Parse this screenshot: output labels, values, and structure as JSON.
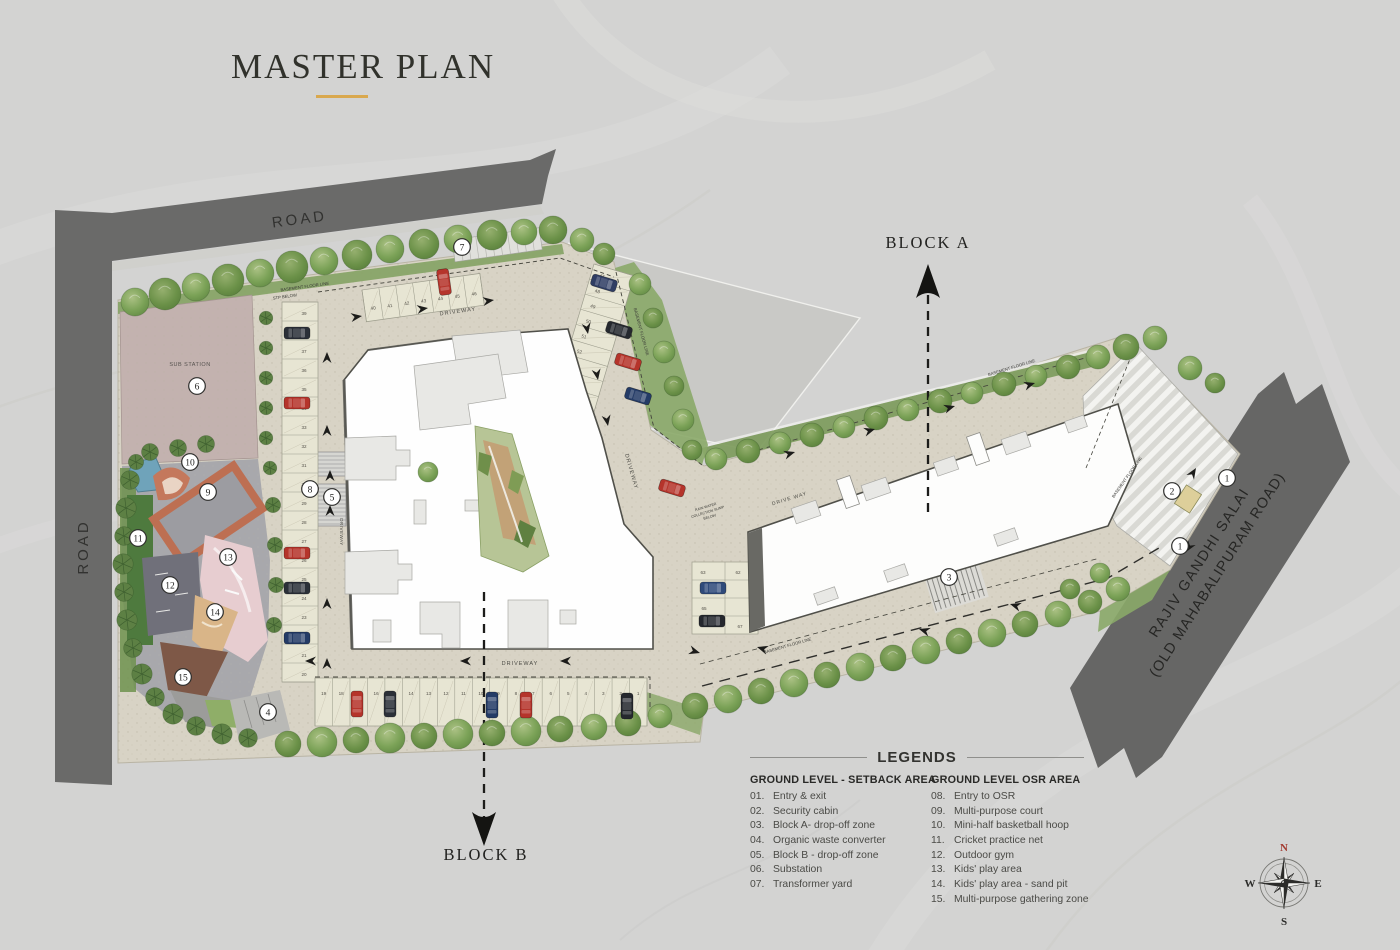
{
  "title": {
    "text": "MASTER PLAN"
  },
  "theme": {
    "accent": "#d9a84e",
    "road": "#6a6a69",
    "site": "#d8d3c5",
    "osr_paving": "#a8a8ac",
    "building": "#fdfdfc",
    "tree_green": "#7f9d60",
    "court_border": "#bd6f52",
    "sand": "#d9b588",
    "pond": "#6fa3ba",
    "marker_red": "#b5342b"
  },
  "labels": {
    "road_top": "ROAD",
    "road_left": "ROAD",
    "highway_line1": "RAJIV GANDHI SALAI",
    "highway_line2": "(OLD MAHABALIPURAM ROAD)",
    "block_a": "BLOCK A",
    "block_b": "BLOCK B",
    "sub_station": "SUB STATION",
    "driveway": "DRIVEWAY",
    "drive_way": "DRIVE WAY",
    "basement_floor_line": "BASEMENT FLOOR LINE",
    "stp_below": "STP BELOW",
    "rain_water_1": "RAIN WATER",
    "rain_water_2": "COLLECTION SUMP",
    "rain_water_3": "BELOW"
  },
  "legend": {
    "heading": "LEGENDS",
    "columns": [
      {
        "header": "GROUND LEVEL - SETBACK AREA",
        "items": [
          {
            "num": "01.",
            "label": "Entry & exit"
          },
          {
            "num": "02.",
            "label": "Security cabin"
          },
          {
            "num": "03.",
            "label": "Block A- drop-off zone"
          },
          {
            "num": "04.",
            "label": "Organic waste converter"
          },
          {
            "num": "05.",
            "label": "Block B - drop-off zone"
          },
          {
            "num": "06.",
            "label": "Substation"
          },
          {
            "num": "07.",
            "label": "Transformer yard"
          }
        ]
      },
      {
        "header": "GROUND LEVEL OSR AREA",
        "items": [
          {
            "num": "08.",
            "label": "Entry to OSR"
          },
          {
            "num": "09.",
            "label": "Multi-purpose court"
          },
          {
            "num": "10.",
            "label": "Mini-half basketball hoop"
          },
          {
            "num": "11.",
            "label": "Cricket practice net"
          },
          {
            "num": "12.",
            "label": "Outdoor gym"
          },
          {
            "num": "13.",
            "label": "Kids' play area"
          },
          {
            "num": "14.",
            "label": "Kids' play area - sand pit"
          },
          {
            "num": "15.",
            "label": "Multi-purpose gathering zone"
          }
        ]
      }
    ]
  },
  "compass": {
    "n": "N",
    "e": "E",
    "s": "S",
    "w": "W"
  },
  "markers": [
    {
      "n": "1",
      "x": 1227,
      "y": 478
    },
    {
      "n": "1",
      "x": 1180,
      "y": 546
    },
    {
      "n": "2",
      "x": 1172,
      "y": 491
    },
    {
      "n": "3",
      "x": 949,
      "y": 577
    },
    {
      "n": "4",
      "x": 268,
      "y": 712
    },
    {
      "n": "5",
      "x": 332,
      "y": 497
    },
    {
      "n": "6",
      "x": 197,
      "y": 386
    },
    {
      "n": "7",
      "x": 462,
      "y": 247
    },
    {
      "n": "8",
      "x": 310,
      "y": 489
    },
    {
      "n": "9",
      "x": 208,
      "y": 492
    },
    {
      "n": "10",
      "x": 190,
      "y": 462
    },
    {
      "n": "11",
      "x": 138,
      "y": 538
    },
    {
      "n": "12",
      "x": 170,
      "y": 585
    },
    {
      "n": "13",
      "x": 228,
      "y": 557
    },
    {
      "n": "14",
      "x": 215,
      "y": 612
    },
    {
      "n": "15",
      "x": 183,
      "y": 677
    }
  ],
  "parking": {
    "west": [
      "39",
      "38",
      "37",
      "36",
      "35",
      "34",
      "33",
      "32",
      "31",
      "30",
      "29",
      "28",
      "27",
      "26",
      "25",
      "24",
      "23",
      "22",
      "21",
      "20"
    ],
    "north": [
      "40",
      "41",
      "42",
      "43",
      "44",
      "45",
      "46"
    ],
    "mid": [
      "47",
      "48",
      "49",
      "50",
      "51",
      "52",
      "53",
      "54",
      "55",
      "56",
      "57",
      "58",
      "59",
      "60",
      "61"
    ],
    "south": [
      "19",
      "18",
      "17",
      "16",
      "15",
      "14",
      "13",
      "12",
      "11",
      "10",
      "9",
      "8",
      "7",
      "6",
      "5",
      "4",
      "3",
      "2",
      "1"
    ],
    "cluster": [
      "63",
      "62",
      "65",
      "67"
    ]
  }
}
